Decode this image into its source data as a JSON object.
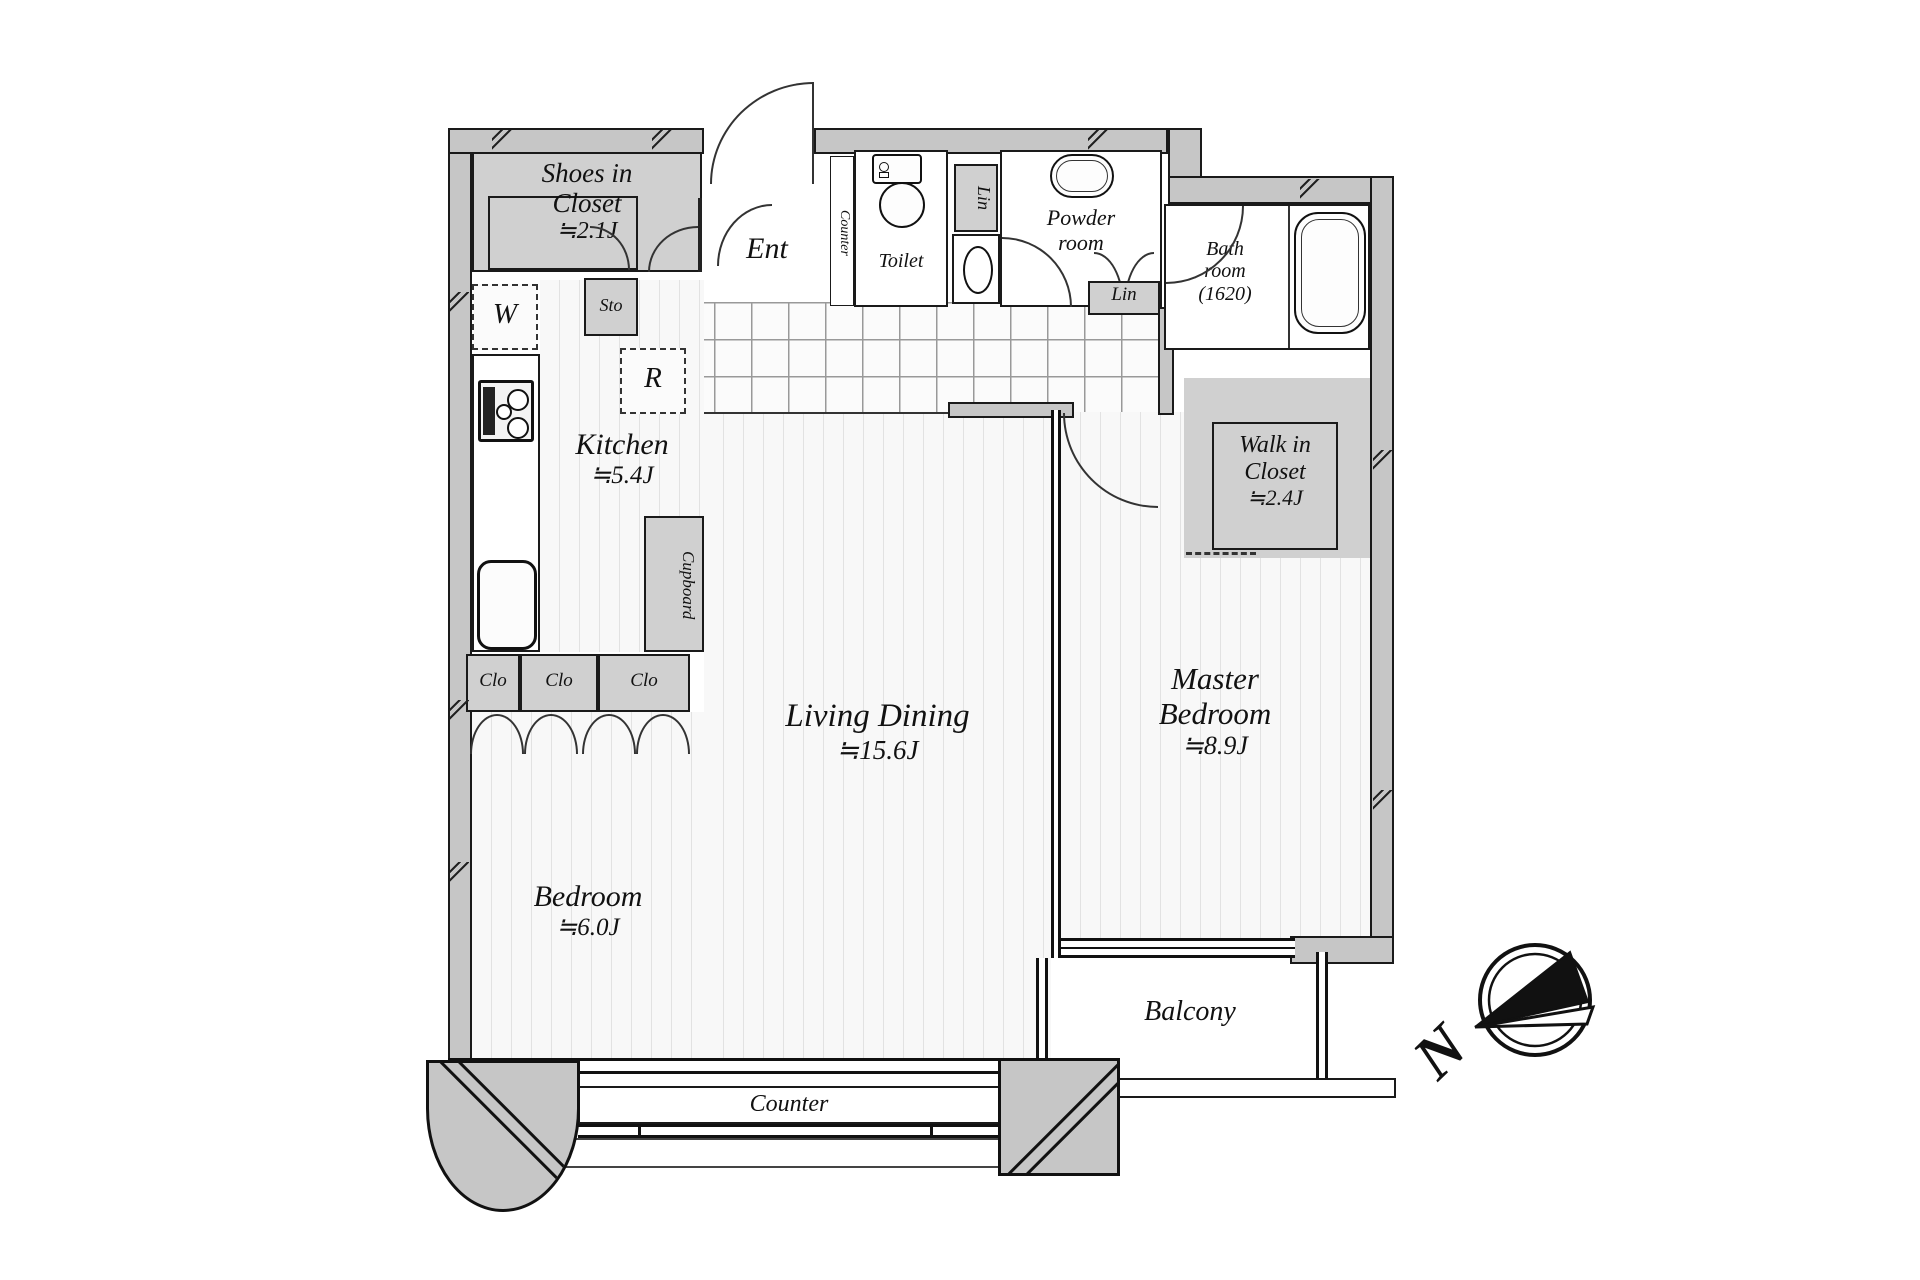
{
  "rooms": {
    "shoes_closet": {
      "lines": [
        "Shoes in",
        "Closet",
        "≒2.1J"
      ]
    },
    "ent": {
      "label": "Ent"
    },
    "hall_counter": {
      "label": "Counter"
    },
    "toilet": {
      "label": "Toilet"
    },
    "linen_upper": {
      "label": "Lin"
    },
    "powder_room": {
      "lines": [
        "Powder",
        "room"
      ]
    },
    "linen_lower": {
      "label": "Lin"
    },
    "bath_room": {
      "lines": [
        "Bath",
        "room",
        "(1620)"
      ]
    },
    "storage": {
      "label": "Sto"
    },
    "washer": {
      "label": "W"
    },
    "refrigerator": {
      "label": "R"
    },
    "kitchen": {
      "name": "Kitchen",
      "area": "≒5.4J"
    },
    "cupboard": {
      "label": "Cupboard"
    },
    "closets": {
      "clo1": "Clo",
      "clo2": "Clo",
      "clo3": "Clo"
    },
    "living_dining": {
      "name": "Living Dining",
      "area": "≒15.6J"
    },
    "walk_in_closet": {
      "lines": [
        "Walk in",
        "Closet",
        "≒2.4J"
      ]
    },
    "master_bedroom": {
      "lines": [
        "Master",
        "Bedroom",
        "≒8.9J"
      ]
    },
    "bedroom": {
      "name": "Bedroom",
      "area": "≒6.0J"
    },
    "balcony": {
      "label": "Balcony"
    },
    "counter": {
      "label": "Counter"
    }
  },
  "compass": {
    "north": "N"
  },
  "colors": {
    "wall": "#c6c6c6",
    "closet": "#d0d0d0",
    "outline": "#1a1a1a",
    "stripe": "#e2e2e2",
    "floor": "#f8f8f8",
    "tile_line": "#999999"
  }
}
